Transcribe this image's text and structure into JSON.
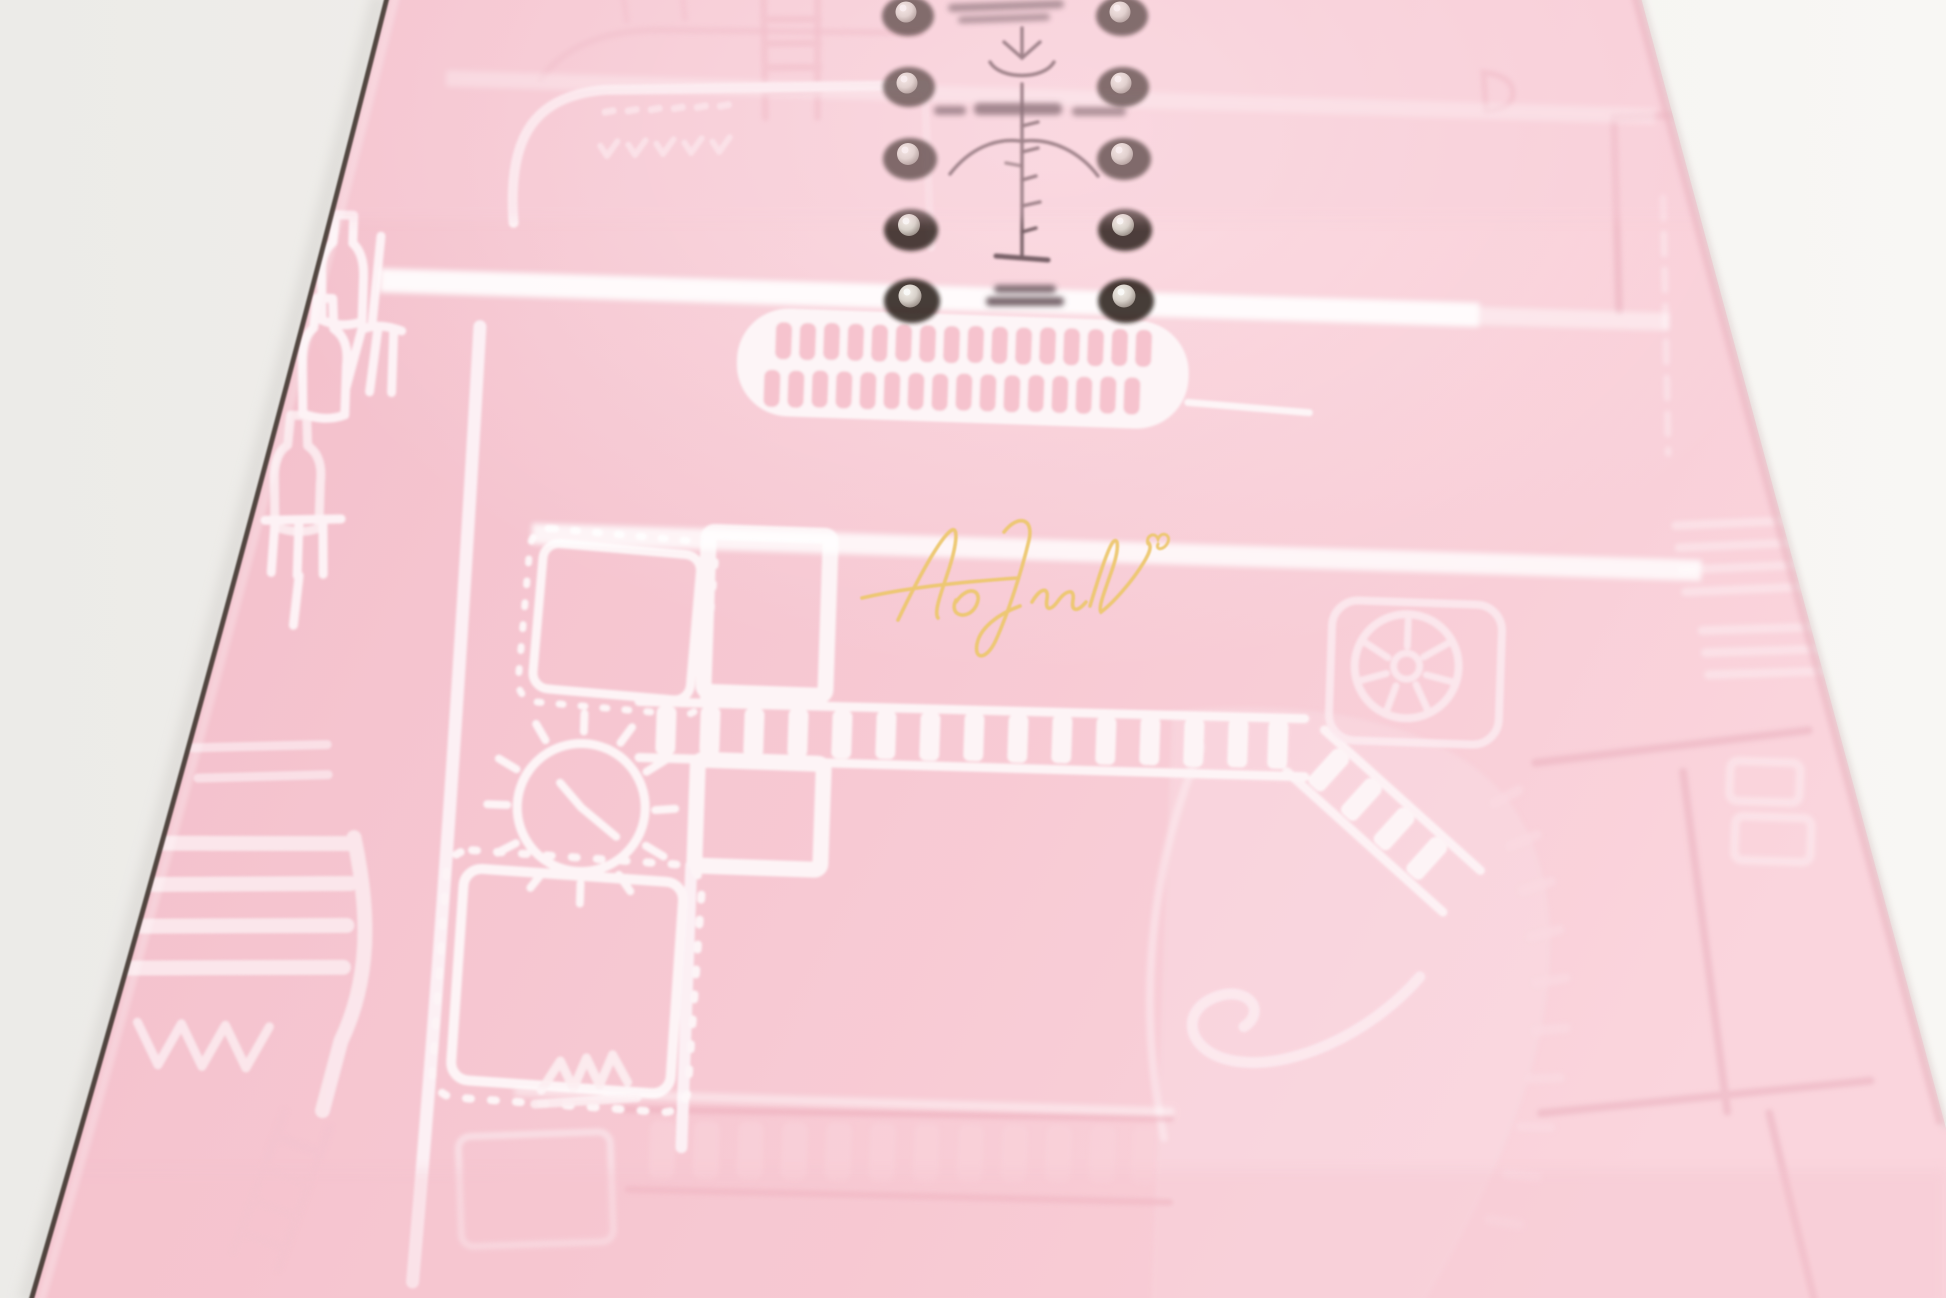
{
  "scene": {
    "subject": "Close-up product photograph of a pastel pink snowboard topsheet, shot at an angle on a white studio background",
    "background": {
      "left": "#eeece9",
      "right": "#f7f6f3"
    },
    "board": {
      "base_pink": "#f6c5cf",
      "pink_light": "#fad4dc",
      "pink_deep": "#f2bcc8",
      "sidewall_edge": "#3f352e",
      "edge_shadow": "#d6d3cf"
    },
    "artwork": {
      "ink_white": "#fdf4f7",
      "ink_soft": "#fbe7ec",
      "tone_pink": "#edb0be",
      "motifs": [
        "doodle bottles",
        "doodle forks",
        "stitched square patches",
        "clock face with ticks",
        "film-strip ladder bands",
        "thick outline panels",
        "spoked reel circle",
        "large faint gear blob",
        "brick-wall seams",
        "crown squiggle",
        "amp panel with dash and check marks"
      ]
    },
    "hardware": {
      "screws_visible": 10,
      "columns": 2,
      "rows": 5,
      "screw_silver": "#d8d1ca",
      "screw_shadow": "#261b17"
    },
    "markings": {
      "color": "#6d575d",
      "items": [
        "two lines of fine print near top inserts (illegible, out of focus)",
        "vertical stance-reference ruler with tick marks and chevrons",
        "small size/stance text row (illegible)",
        "two-line camber label below ruler (illegible)"
      ]
    },
    "signature": {
      "color": "#ecc76e",
      "description": "gold cursive autograph ending in a small heart",
      "legible": false
    },
    "stripes": {
      "gloss_white": "#ffffff",
      "count": 4
    }
  }
}
